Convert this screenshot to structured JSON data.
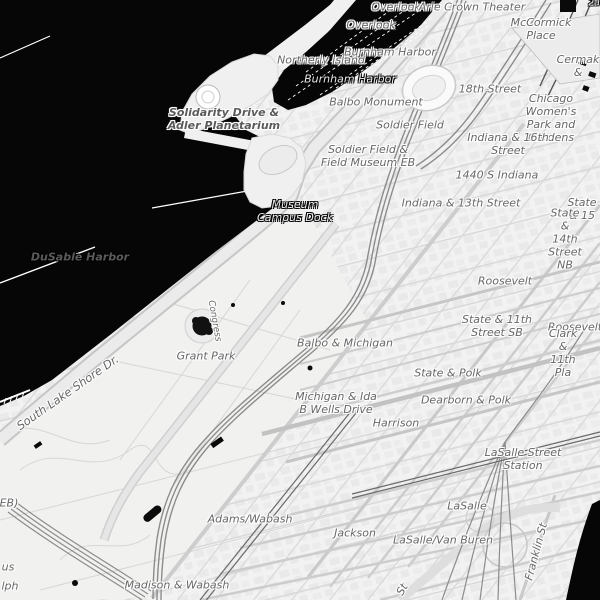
{
  "map": {
    "description": "Grayscale street map, Chicago South Loop / Grant Park / Museum Campus with Lake Michigan shown black",
    "colors": {
      "water": "#060606",
      "land": "#f2f2f2",
      "park": "#f1f1ef",
      "road": "#dcdcdc",
      "road_major": "#c6c6c6",
      "rail": "#8c8c8c",
      "label": "#676767",
      "water_label": "#e9e9e9",
      "halo": "#ffffff"
    },
    "water_bodies": [
      "Lake Michigan",
      "Burnham Harbor",
      "DuSable Harbor"
    ],
    "labels": [
      {
        "t": "Overlook",
        "x": 396,
        "y": 8
      },
      {
        "t": "Overlook",
        "x": 371,
        "y": 26
      },
      {
        "t": "Arie Crown Theater",
        "x": 472,
        "y": 8
      },
      {
        "t": "McCormick Place",
        "x": 541,
        "y": 30
      },
      {
        "t": "Cermak &",
        "x": 578,
        "y": 67
      },
      {
        "t": "Northerly Island",
        "x": 321,
        "y": 61
      },
      {
        "t": "Burnham Harbor",
        "x": 390,
        "y": 53
      },
      {
        "t": "Burnham Harbor",
        "x": 350,
        "y": 80,
        "c": "water"
      },
      {
        "t": "Balbo Monument",
        "x": 376,
        "y": 103
      },
      {
        "t": "18th Street",
        "x": 490,
        "y": 90
      },
      {
        "t": "Chicago Women's\nPark and Gardens",
        "x": 551,
        "y": 119
      },
      {
        "t": "Soldier Field",
        "x": 410,
        "y": 126
      },
      {
        "t": "Soldier Field &\nField Museum EB",
        "x": 368,
        "y": 157
      },
      {
        "t": "Indiana & 16th Street",
        "x": 508,
        "y": 145
      },
      {
        "t": "1440 S Indiana",
        "x": 497,
        "y": 176
      },
      {
        "t": "Indiana & 13th Street",
        "x": 461,
        "y": 204
      },
      {
        "t": "State & 15",
        "x": 582,
        "y": 210
      },
      {
        "t": "State & 14th\nStreet NB",
        "x": 565,
        "y": 240
      },
      {
        "t": "Solidarity Drive &\nAdler Planetarium",
        "x": 224,
        "y": 120,
        "c": "bold"
      },
      {
        "t": "Museum\nCampus Dock",
        "x": 295,
        "y": 212,
        "c": "water"
      },
      {
        "t": "DuSable Harbor",
        "x": 80,
        "y": 258,
        "c": "water bold"
      },
      {
        "t": "Roosevelt",
        "x": 505,
        "y": 282
      },
      {
        "t": "State & 11th\nStreet SB",
        "x": 497,
        "y": 327
      },
      {
        "t": "Roosevelt",
        "x": 575,
        "y": 328
      },
      {
        "t": "Clark & 11th Pla",
        "x": 563,
        "y": 354
      },
      {
        "t": "Grant Park",
        "x": 206,
        "y": 357
      },
      {
        "t": "Balbo & Michigan",
        "x": 345,
        "y": 344
      },
      {
        "t": "Congress",
        "x": 214,
        "y": 321,
        "r": 80,
        "s": 9
      },
      {
        "t": "State & Polk",
        "x": 448,
        "y": 374
      },
      {
        "t": "Dearborn & Polk",
        "x": 466,
        "y": 401
      },
      {
        "t": "Michigan & Ida\nB Wells Drive",
        "x": 336,
        "y": 404
      },
      {
        "t": "Harrison",
        "x": 396,
        "y": 424
      },
      {
        "t": "South Lake Shore Dr.",
        "x": 68,
        "y": 393,
        "r": -35,
        "s": 11.5
      },
      {
        "t": "LaSalle Street Station",
        "x": 523,
        "y": 460
      },
      {
        "t": "LaSalle",
        "x": 467,
        "y": 507
      },
      {
        "t": "LaSalle/Van Buren",
        "x": 443,
        "y": 541
      },
      {
        "t": "Adams/Wabash",
        "x": 250,
        "y": 520
      },
      {
        "t": "Jackson",
        "x": 355,
        "y": 534
      },
      {
        "t": "Madison & Wabash",
        "x": 177,
        "y": 586
      },
      {
        "t": "Franklin St",
        "x": 537,
        "y": 552,
        "r": -75
      },
      {
        "t": "St",
        "x": 403,
        "y": 590,
        "r": -60
      },
      {
        "t": "us",
        "x": 8,
        "y": 568
      },
      {
        "t": "lph",
        "x": 10,
        "y": 587
      },
      {
        "t": "EB)",
        "x": 9,
        "y": 504
      },
      {
        "t": "2a",
        "x": 594,
        "y": 4,
        "c": "water",
        "s": 9
      }
    ]
  }
}
